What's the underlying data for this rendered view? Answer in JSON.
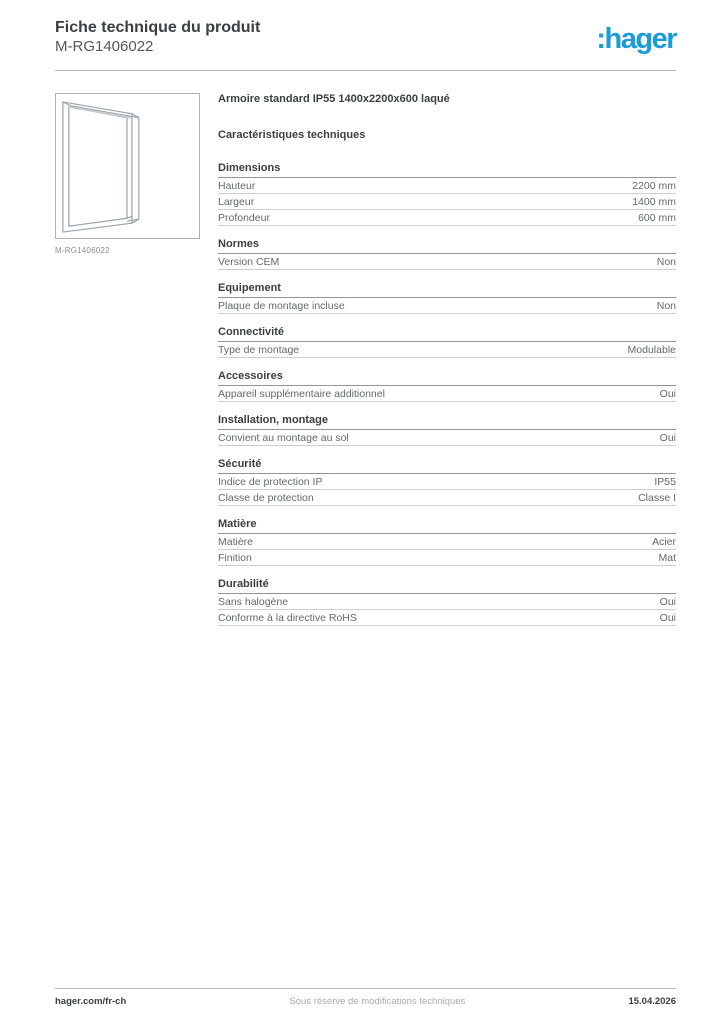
{
  "header": {
    "title": "Fiche technique du produit",
    "reference": "M-RG1406022",
    "logo_text": ":hager",
    "logo_color": "#1a9cd8"
  },
  "product": {
    "name": "Armoire standard IP55 1400x2200x600 laqué",
    "image_caption": "M-RG1406022",
    "image_description": "cabinet-frame-wireframe"
  },
  "table": {
    "heading": "Caractéristiques techniques",
    "sections": [
      {
        "title": "Dimensions",
        "rows": [
          {
            "label": "Hauteur",
            "value": "2200 mm"
          },
          {
            "label": "Largeur",
            "value": "1400 mm"
          },
          {
            "label": "Profondeur",
            "value": "600 mm"
          }
        ]
      },
      {
        "title": "Normes",
        "rows": [
          {
            "label": "Version CEM",
            "value": "Non"
          }
        ]
      },
      {
        "title": "Equipement",
        "rows": [
          {
            "label": "Plaque de montage incluse",
            "value": "Non"
          }
        ]
      },
      {
        "title": "Connectivité",
        "rows": [
          {
            "label": "Type de montage",
            "value": "Modulable"
          }
        ]
      },
      {
        "title": "Accessoires",
        "rows": [
          {
            "label": "Appareil supplémentaire additionnel",
            "value": "Oui"
          }
        ]
      },
      {
        "title": "Installation, montage",
        "rows": [
          {
            "label": "Convient au montage au sol",
            "value": "Oui"
          }
        ]
      },
      {
        "title": "Sécurité",
        "rows": [
          {
            "label": "Indice de protection IP",
            "value": "IP55"
          },
          {
            "label": "Classe de protection",
            "value": "Classe I"
          }
        ]
      },
      {
        "title": "Matière",
        "rows": [
          {
            "label": "Matière",
            "value": "Acier"
          },
          {
            "label": "Finition",
            "value": "Mat"
          }
        ]
      },
      {
        "title": "Durabilité",
        "rows": [
          {
            "label": "Sans halogène",
            "value": "Oui"
          },
          {
            "label": "Conforme à la directive RoHS",
            "value": "Oui"
          }
        ]
      }
    ]
  },
  "footer": {
    "left": "hager.com/fr-ch",
    "center": "Sous réserve de modifications techniques",
    "right": "15.04.2026"
  }
}
